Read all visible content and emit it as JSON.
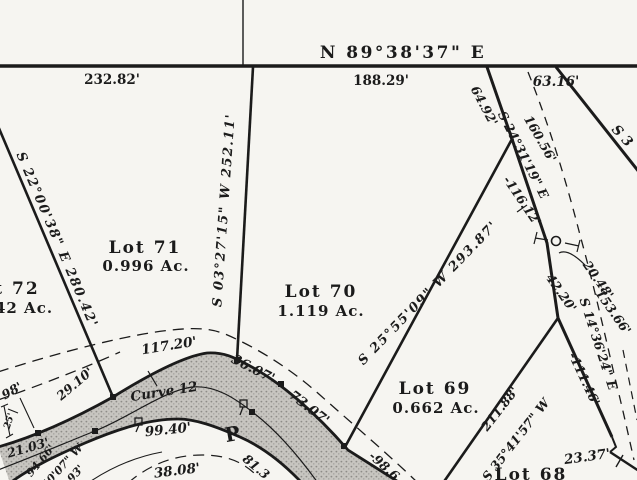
{
  "colors": {
    "paper": "#f6f5f1",
    "ink": "#1b1b1b",
    "road_fill": "#c7c5c0",
    "road_dot": "#8e8c88"
  },
  "north_boundary": {
    "bearing": "N 89°38'37\" E",
    "dist_left": "232.82'",
    "dist_mid": "188.29'",
    "dist_right": "63.16'"
  },
  "lots": [
    {
      "name": "t 72",
      "area": "42 Ac."
    },
    {
      "name": "Lot 71",
      "area": "0.996 Ac."
    },
    {
      "name": "Lot 70",
      "area": "1.119 Ac."
    },
    {
      "name": "Lot 69",
      "area": "0.662 Ac."
    },
    {
      "name": "Lot 68"
    }
  ],
  "lot_lines": {
    "lot72_71": "S 22°00'38\" E  280.42'",
    "lot71_70": "S 03°27'15\" W  252.11'",
    "lot70_69": "S 25°55'09\" W  293.87'",
    "lot69_68_dist": "211.88'",
    "lot69_68_bearing": "S 35°41'57\" W"
  },
  "east_line": {
    "seg_top": "64.92'",
    "bearing_upper": "S 24°31'19\" E",
    "d_160": "160.56'",
    "d_116": "-116.12'",
    "d_42": "42.20'",
    "d_20": "20.48'",
    "d_153": "153.66'",
    "bearing_lower": "S 14°36'24\" E",
    "d_111": "-111.46'",
    "d_23": "23.37'",
    "partial_ne": "S 3"
  },
  "road": {
    "name": "Curve 12",
    "marker": "P",
    "d_117": "117.20'",
    "d_36": "36.07'",
    "d_73": "73.07'",
    "d_29": "29.10'",
    "d_99": "99.40'",
    "d_81": "81.3",
    "d_38": "38.08'",
    "d_98_6": "-98.6",
    "d_21": "21.03'",
    "d_98": "98'",
    "d_25": "25'",
    "d_94": "94.66'",
    "partial_brg": "40'07\" W",
    "d_93": "93'"
  }
}
